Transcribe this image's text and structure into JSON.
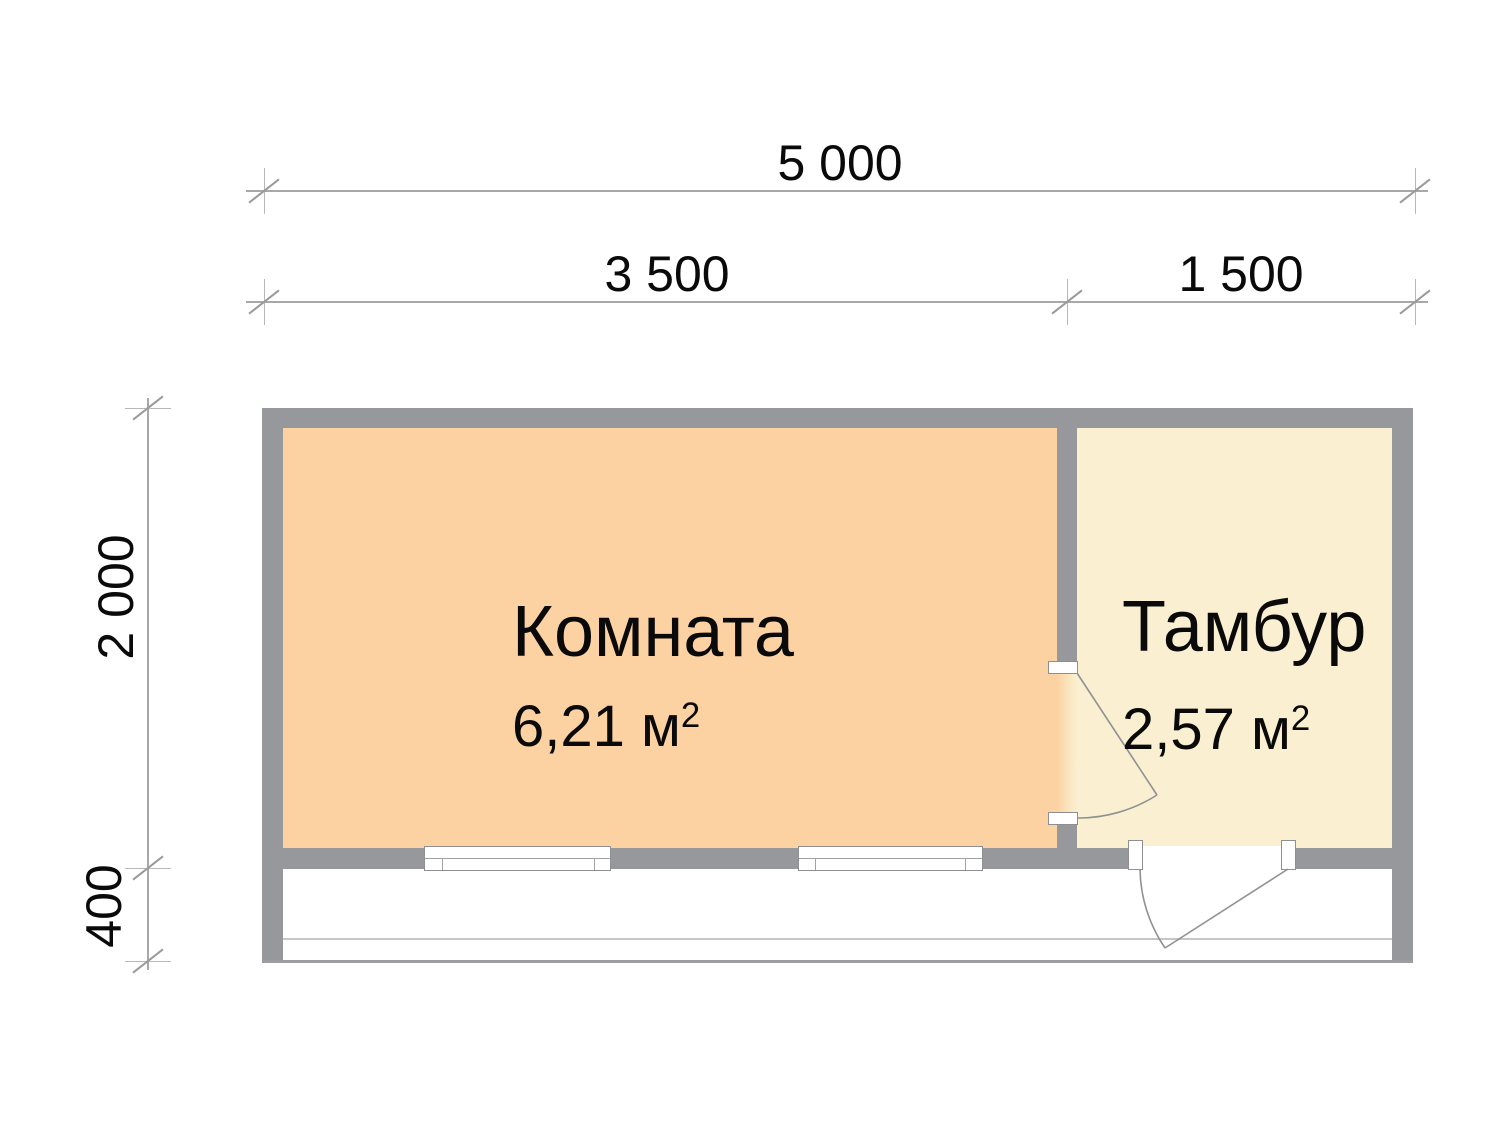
{
  "drawing": {
    "type": "floor-plan",
    "units": "mm"
  },
  "dimensions": {
    "total_width_mm": "5 000",
    "main_room_width_mm": "3 500",
    "vestibule_width_mm": "1 500",
    "depth_mm": "2 000",
    "porch_depth_mm": "400"
  },
  "rooms": {
    "main": {
      "name": "Комната",
      "area": "6,21 м",
      "area_sup": "2"
    },
    "vestibule": {
      "name": "Тамбур",
      "area": "2,57 м",
      "area_sup": "2"
    }
  },
  "colors": {
    "wall": "#96989B",
    "main_room_fill": "#FCD2A3",
    "vestibule_fill": "#FAF0D1",
    "dimension_line": "#A8A8A8",
    "text": "#0A0A0A"
  }
}
